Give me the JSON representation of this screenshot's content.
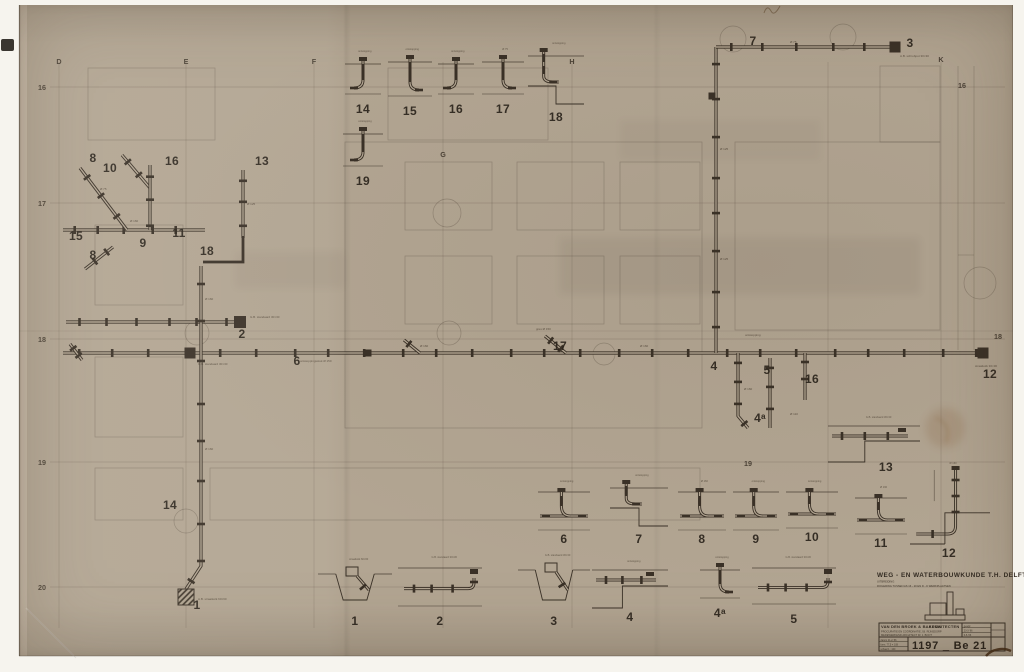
{
  "colors": {
    "paper": "#b2a592",
    "ink": "#3a3127",
    "label_ink": "#2b241c",
    "page_bg": "#f6f4ee"
  },
  "titleblock": {
    "title": "WEG - EN WATERBOUWKUNDE  T.H. DELFT",
    "sub1": "UITBREIDING",
    "sub2": "RIOLERING TUSSEN AS 16 - 20 EN D - K   WERKPLAATSEN",
    "firm": "VAN DEN BROEK & BAKEMA",
    "firm_right": "ARCHITECTEN",
    "line2": "PROCURATIE EN COÖRDINATIE    J.B. RIJNSDORP",
    "line3": "MEDEWERKEND ARCHITECT    IR. J. BOOT",
    "rev_rows": [
      "gewijz.",
      "23-3-'66",
      "6-5-'66"
    ],
    "stamp_rows": [
      "datum  21-2-'66",
      "form.  77,5 × 108",
      "schaal  1 : 100"
    ],
    "number": "1197 _ Be 21"
  },
  "plan": {
    "grid_cols": [
      {
        "label": "D",
        "x": 59,
        "y": 64
      },
      {
        "label": "E",
        "x": 186,
        "y": 64
      },
      {
        "label": "F",
        "x": 314,
        "y": 64
      },
      {
        "label": "G",
        "x": 443,
        "y": 157
      },
      {
        "label": "H",
        "x": 572,
        "y": 64
      },
      {
        "label": "K",
        "x": 941,
        "y": 62
      }
    ],
    "grid_rows": [
      {
        "label": "16",
        "y": 90
      },
      {
        "label": "17",
        "y": 206
      },
      {
        "label": "18",
        "y": 342
      },
      {
        "label": "19",
        "y": 465
      },
      {
        "label": "20",
        "y": 590
      }
    ],
    "extra_labels": [
      {
        "t": "16",
        "x": 962,
        "y": 88
      },
      {
        "t": "18",
        "x": 998,
        "y": 339
      },
      {
        "t": "19",
        "x": 748,
        "y": 466
      }
    ],
    "unlabeled_cols": [
      828
    ],
    "runs": [
      {
        "pts": [
          [
            63,
            353
          ],
          [
            988,
            353
          ]
        ],
        "cs": 36
      },
      {
        "pts": [
          [
            66,
            322
          ],
          [
            234,
            322
          ]
        ],
        "cs": 30
      },
      {
        "pts": [
          [
            63,
            230
          ],
          [
            205,
            230
          ]
        ],
        "cs": 26
      },
      {
        "pts": [
          [
            80,
            168
          ],
          [
            127,
            230
          ]
        ],
        "cs": 26
      },
      {
        "pts": [
          [
            113,
            247
          ],
          [
            85,
            269
          ]
        ],
        "cs": 18
      },
      {
        "pts": [
          [
            122,
            155
          ],
          [
            150,
            188
          ]
        ],
        "cs": 20
      },
      {
        "pts": [
          [
            150,
            165
          ],
          [
            150,
            230
          ]
        ],
        "cs": 26
      },
      {
        "pts": [
          [
            243,
            170
          ],
          [
            243,
            238
          ]
        ],
        "cs": 24
      },
      {
        "pts": [
          [
            201,
            266
          ],
          [
            201,
            566
          ],
          [
            186,
            589
          ]
        ],
        "cs": 40
      },
      {
        "pts": [
          [
            716,
            47
          ],
          [
            716,
            353
          ]
        ],
        "cs": 38
      },
      {
        "pts": [
          [
            716,
            47
          ],
          [
            890,
            47
          ]
        ],
        "cs": 34
      },
      {
        "pts": [
          [
            738,
            353
          ],
          [
            738,
            416
          ],
          [
            748,
            428
          ]
        ],
        "cs": 22
      },
      {
        "pts": [
          [
            770,
            358
          ],
          [
            770,
            428
          ]
        ],
        "cs": 22
      },
      {
        "pts": [
          [
            805,
            353
          ],
          [
            805,
            400
          ]
        ],
        "cs": 20
      },
      {
        "pts": [
          [
            545,
            336
          ],
          [
            566,
            353
          ]
        ],
        "cs": 16
      },
      {
        "pts": [
          [
            404,
            340
          ],
          [
            420,
            353
          ]
        ],
        "cs": 14
      },
      {
        "pts": [
          [
            70,
            344
          ],
          [
            82,
            360
          ]
        ],
        "cs": 12
      }
    ],
    "bold_elbow": "M243,236 V262 H203",
    "joints": [
      [
        240,
        322,
        12
      ],
      [
        190,
        353,
        11
      ],
      [
        983,
        353,
        11
      ],
      [
        895,
        47,
        11
      ],
      [
        368,
        353,
        7
      ],
      [
        712,
        96,
        7
      ]
    ],
    "hatch_box": [
      178,
      589,
      16,
      16
    ],
    "callouts": [
      {
        "t": "8",
        "x": 93,
        "y": 162
      },
      {
        "t": "10",
        "x": 110,
        "y": 172
      },
      {
        "t": "16",
        "x": 172,
        "y": 165
      },
      {
        "t": "13",
        "x": 262,
        "y": 165
      },
      {
        "t": "15",
        "x": 76,
        "y": 240
      },
      {
        "t": "11",
        "x": 179,
        "y": 237
      },
      {
        "t": "9",
        "x": 143,
        "y": 247
      },
      {
        "t": "8",
        "x": 93,
        "y": 259
      },
      {
        "t": "18",
        "x": 207,
        "y": 255
      },
      {
        "t": "2",
        "x": 242,
        "y": 338
      },
      {
        "t": "6",
        "x": 297,
        "y": 365
      },
      {
        "t": "17",
        "x": 560,
        "y": 350
      },
      {
        "t": "4",
        "x": 714,
        "y": 370
      },
      {
        "t": "5",
        "x": 767,
        "y": 374
      },
      {
        "t": "16",
        "x": 812,
        "y": 383
      },
      {
        "t": "4ᵃ",
        "x": 760,
        "y": 422
      },
      {
        "t": "14",
        "x": 170,
        "y": 509
      },
      {
        "t": "1",
        "x": 197,
        "y": 609
      },
      {
        "t": "7",
        "x": 753,
        "y": 45
      },
      {
        "t": "3",
        "x": 910,
        "y": 47
      },
      {
        "t": "12",
        "x": 990,
        "y": 378
      }
    ],
    "notes": [
      {
        "t": "G.B. standaard 30×30",
        "x": 250,
        "y": 318
      },
      {
        "t": "G.B. standaard 30×30",
        "x": 198,
        "y": 365
      },
      {
        "t": "ontstoppingsstuk Ø 150",
        "x": 300,
        "y": 362
      },
      {
        "t": "gres Ø 150",
        "x": 536,
        "y": 330
      },
      {
        "t": "A.B. schrobput 30×30",
        "x": 900,
        "y": 57
      },
      {
        "t": "A.B. straatkolk 60×60",
        "x": 198,
        "y": 600
      },
      {
        "t": "straatkolk 30×30",
        "x": 975,
        "y": 367
      },
      {
        "t": "Ø 160",
        "x": 205,
        "y": 300
      },
      {
        "t": "Ø 160",
        "x": 205,
        "y": 450
      },
      {
        "t": "Ø 125",
        "x": 247,
        "y": 205
      },
      {
        "t": "Ø 125",
        "x": 720,
        "y": 150
      },
      {
        "t": "Ø 125",
        "x": 720,
        "y": 260
      },
      {
        "t": "Ø 160",
        "x": 420,
        "y": 347
      },
      {
        "t": "Ø 160",
        "x": 640,
        "y": 347
      },
      {
        "t": "Ø 75",
        "x": 790,
        "y": 43
      },
      {
        "t": "Ø 160",
        "x": 130,
        "y": 222
      },
      {
        "t": "Ø 75",
        "x": 100,
        "y": 190
      },
      {
        "t": "ontstopping",
        "x": 745,
        "y": 336
      },
      {
        "t": "Ø 160",
        "x": 744,
        "y": 390
      },
      {
        "t": "Ø 110",
        "x": 790,
        "y": 415
      }
    ]
  },
  "details": [
    {
      "label": "14",
      "variant": "riser",
      "x": 345,
      "y": 54,
      "w": 36,
      "h": 46,
      "note": "ontstopping"
    },
    {
      "label": "15",
      "variant": "riser-r",
      "x": 388,
      "y": 52,
      "w": 44,
      "h": 50,
      "note": "ontstopping"
    },
    {
      "label": "16",
      "variant": "riser",
      "x": 438,
      "y": 54,
      "w": 36,
      "h": 46,
      "note": "ontstopping"
    },
    {
      "label": "17",
      "variant": "riser-r",
      "x": 482,
      "y": 52,
      "w": 42,
      "h": 48,
      "note": "Ø 75"
    },
    {
      "label": "18",
      "variant": "step",
      "x": 528,
      "y": 46,
      "w": 56,
      "h": 62,
      "note": "ontstopping"
    },
    {
      "label": "19",
      "variant": "riser",
      "x": 343,
      "y": 124,
      "w": 40,
      "h": 48,
      "note": "ontstopping"
    },
    {
      "label": "6",
      "variant": "tee",
      "x": 538,
      "y": 484,
      "w": 52,
      "h": 46,
      "note": "ontstopping"
    },
    {
      "label": "7",
      "variant": "step",
      "x": 610,
      "y": 478,
      "w": 58,
      "h": 52,
      "note": "ontstopping"
    },
    {
      "label": "8",
      "variant": "tee",
      "x": 678,
      "y": 484,
      "w": 48,
      "h": 46,
      "note": "Ø 160"
    },
    {
      "label": "9",
      "variant": "tee",
      "x": 733,
      "y": 484,
      "w": 46,
      "h": 46,
      "note": "ontstopping"
    },
    {
      "label": "10",
      "variant": "tee",
      "x": 786,
      "y": 484,
      "w": 52,
      "h": 44,
      "note": "ontstopping"
    },
    {
      "label": "11",
      "variant": "tee",
      "x": 855,
      "y": 490,
      "w": 52,
      "h": 44,
      "note": "Ø 160"
    },
    {
      "label": "12",
      "variant": "corner-tall",
      "x": 908,
      "y": 466,
      "w": 82,
      "h": 78,
      "note": "Ø 160"
    },
    {
      "label": "13",
      "variant": "horiz",
      "x": 828,
      "y": 420,
      "w": 92,
      "h": 42,
      "lx": 886,
      "ly": 471,
      "note": "G.B. standaard 30×30"
    },
    {
      "label": "1",
      "variant": "trench",
      "x": 318,
      "y": 562,
      "w": 74,
      "h": 50,
      "note": "straatkolk 60×60"
    },
    {
      "label": "2",
      "variant": "trench-h",
      "x": 398,
      "y": 560,
      "w": 84,
      "h": 52,
      "note": "G.B. standaard 30×30"
    },
    {
      "label": "3",
      "variant": "trench",
      "x": 518,
      "y": 558,
      "w": 72,
      "h": 54,
      "note": "G.B. standaard 30×30"
    },
    {
      "label": "4",
      "variant": "horiz",
      "x": 592,
      "y": 564,
      "w": 76,
      "h": 44,
      "note": "ontstopping"
    },
    {
      "label": "4ᵃ",
      "variant": "riser-r",
      "x": 700,
      "y": 560,
      "w": 40,
      "h": 44,
      "note": "ontstopping"
    },
    {
      "label": "5",
      "variant": "trench-h",
      "x": 752,
      "y": 560,
      "w": 84,
      "h": 50,
      "note": "G.B. standaard 30×30"
    }
  ]
}
